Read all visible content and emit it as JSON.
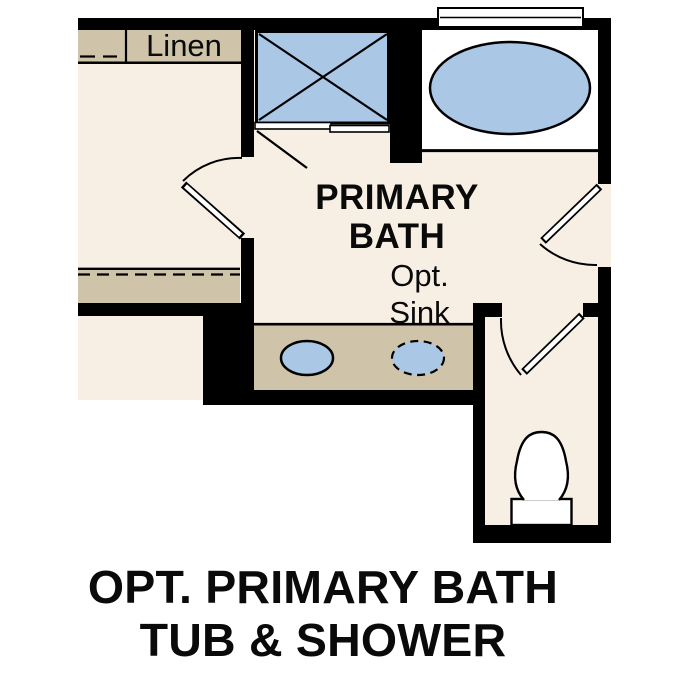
{
  "plan": {
    "room_label": {
      "line1": "PRIMARY",
      "line2": "BATH"
    },
    "option_label": {
      "line1": "Opt.",
      "line2": "Sink"
    },
    "closet_label": "Linen",
    "fixtures": [
      "linen-shelf",
      "wardrobe-shelf-dashed",
      "walk-in-shower",
      "shower-sliding-door",
      "soaking-tub",
      "window",
      "vanity-counter",
      "sink",
      "optional-sink-dashed",
      "toilet",
      "swing-door-closet",
      "swing-door-entry",
      "swing-door-water-closet"
    ]
  },
  "caption": {
    "line1": "OPT. PRIMARY BATH",
    "line2": "TUB & SHOWER"
  },
  "colors": {
    "wall": "#000000",
    "floor": "#f7efe4",
    "casework": "#cfc3aa",
    "fixture_blue": "#aac8e6",
    "fixture_white": "#ffffff",
    "background": "#ffffff",
    "text": "#0a0a0a"
  }
}
